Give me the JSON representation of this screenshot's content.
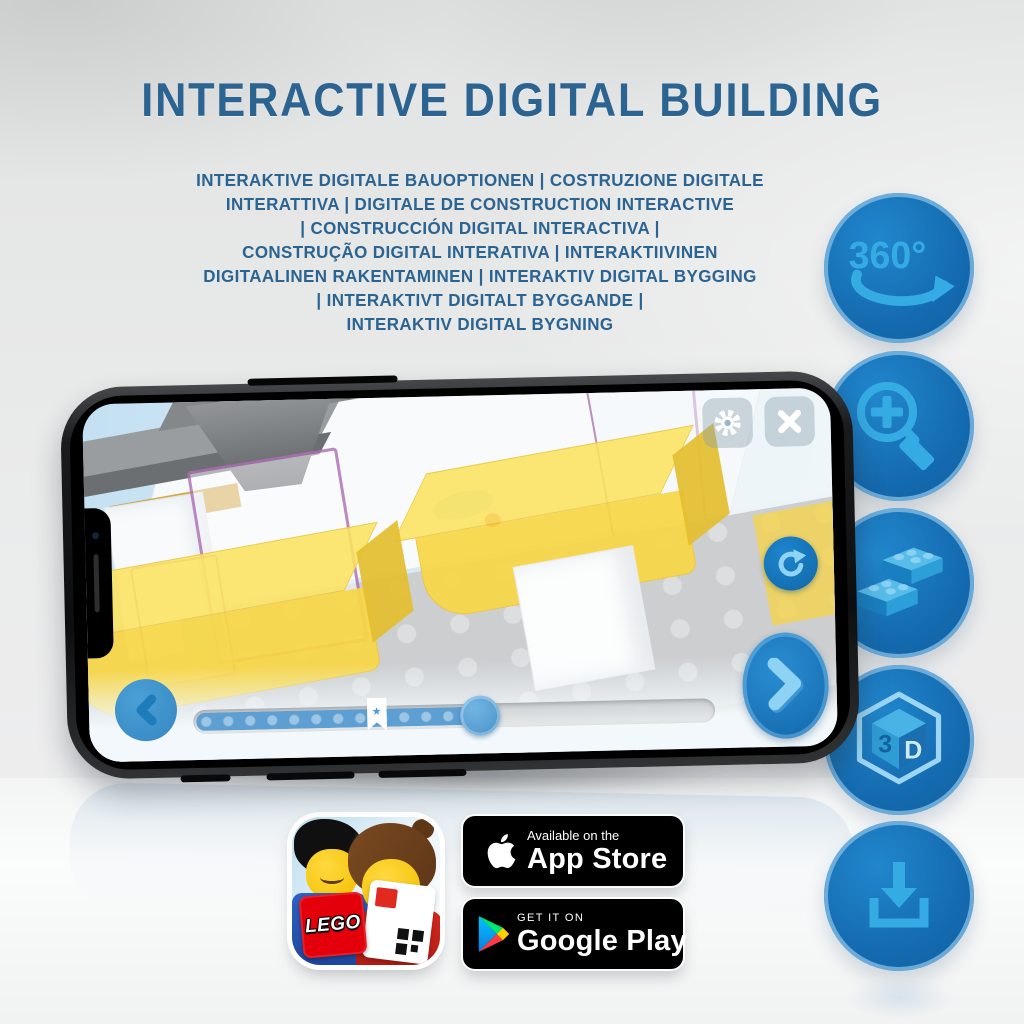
{
  "page": {
    "title": "INTERACTIVE DIGITAL BUILDING"
  },
  "subtitle": {
    "lines": [
      "INTERAKTIVE DIGITALE BAUOPTIONEN | COSTRUZIONE DIGITALE",
      "INTERATTIVA | DIGITALE DE CONSTRUCTION INTERACTIVE",
      "| CONSTRUCCIÓN DIGITAL INTERACTIVA |",
      "CONSTRUÇÃO DIGITAL INTERATIVA | INTERAKTIIVINEN",
      "DIGITAALINEN RAKENTAMINEN | INTERAKTIV DIGITAL BYGGING",
      "| INTERAKTIVT DIGITALT BYGGANDE |",
      "INTERAKTIV DIGITAL BYGNING"
    ]
  },
  "features": [
    {
      "id": "rotate-360",
      "label": "360°"
    },
    {
      "id": "zoom-in"
    },
    {
      "id": "brick-building"
    },
    {
      "id": "view-3d",
      "label_left": "3",
      "label_right": "D"
    },
    {
      "id": "download"
    }
  ],
  "phone_app": {
    "progress": {
      "fill_percent": 55,
      "bookmark_percent": 39,
      "bookmark_glyph": "★"
    }
  },
  "store_badges": {
    "app_store": {
      "tagline": "Available on the",
      "store": "App Store"
    },
    "google_play": {
      "tagline": "GET IT ON",
      "store": "Google Play"
    }
  },
  "app_icon": {
    "logo": "LEGO"
  },
  "colors": {
    "title_blue": "#2b6391",
    "circle_blue": "#156bb0",
    "icon_light_blue": "#35abe4",
    "screen_sky": "#cfe7f4",
    "bed_yellow": "#f7d64b",
    "ui_blue": "#3f97cf",
    "badge_bg": "#000000"
  }
}
